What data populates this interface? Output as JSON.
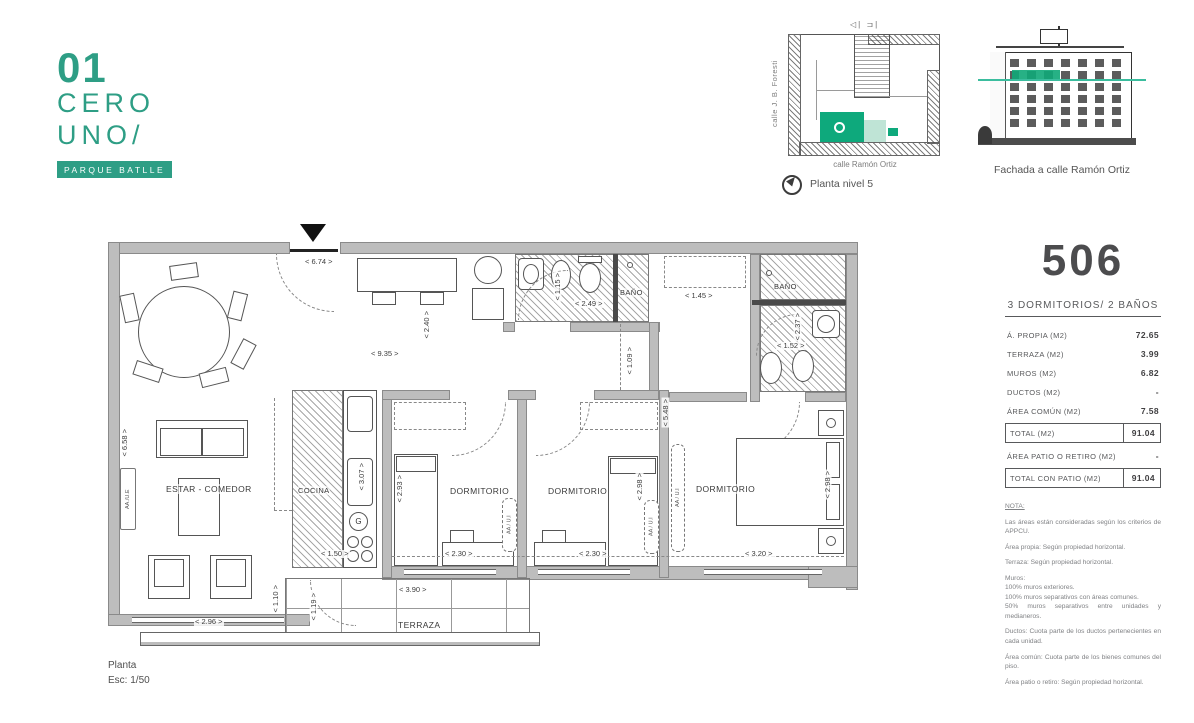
{
  "brand": {
    "number": "01",
    "word1": "CERO",
    "word2": "UNO/",
    "tagline": "PARQUE BATLLE"
  },
  "site_plan": {
    "section_markers": "◁|  ⊐|",
    "street_left": "calle J. B. Foresti",
    "street_bottom": "calle Ramón Ortiz",
    "caption": "Planta nivel 5"
  },
  "facade": {
    "caption": "Fachada a calle Ramón Ortiz"
  },
  "unit_panel": {
    "number": "506",
    "subtitle": "3 DORMITORIOS/ 2 BAÑOS",
    "rows": [
      {
        "label": "Á. PROPIA (M2)",
        "value": "72.65"
      },
      {
        "label": "TERRAZA (M2)",
        "value": "3.99"
      },
      {
        "label": "MUROS (M2)",
        "value": "6.82"
      },
      {
        "label": "DUCTOS  (M2)",
        "value": "-"
      },
      {
        "label": "ÁREA COMÚN (M2)",
        "value": "7.58"
      },
      {
        "label": "TOTAL (M2)",
        "value": "91.04"
      },
      {
        "label": "ÁREA PATIO O RETIRO (M2)",
        "value": "-"
      },
      {
        "label": "TOTAL CON PATIO (M2)",
        "value": "91.04"
      }
    ]
  },
  "notes": {
    "title": "NOTA:",
    "paragraphs": [
      "Las áreas están consideradas según los criterios de APPCU.",
      "Área propia: Según propiedad horizontal.",
      "Terraza: Según propiedad horizontal.",
      "Muros:\n100% muros exteriores.\n100% muros separativos con áreas comunes.\n50% muros separativos entre unidades y medianeros.",
      "Ductos: Cuota parte de los ductos pertenecientes en cada unidad.",
      "Área común: Cuota parte de los bienes comunes del piso.",
      "Área patio o retiro: Según propiedad horizontal."
    ]
  },
  "plan": {
    "labels": {
      "living": "ESTAR - COMEDOR",
      "kitchen": "COCINA",
      "bedroom": "DORMITORIO",
      "bath": "BAÑO",
      "terrace": "TERRAZA"
    },
    "dims": {
      "d674": "< 6.74 >",
      "d935": "< 9.35 >",
      "d240": "< 2.40 >",
      "d115": "< 1.15 >",
      "d249": "< 2.49 >",
      "d145": "< 1.45 >",
      "d237": "< 2.37 >",
      "d152": "< 1.52 >",
      "d109": "< 1.09 >",
      "d658": "< 6.58 >",
      "d307": "< 3.07 >",
      "d150": "< 1.50 >",
      "d293": "< 2.93 >",
      "d230": "< 2.30 >",
      "d298": "< 2.98 >",
      "d548": "< 5.48 >",
      "d320": "< 3.20 >",
      "d296": "< 2.96 >",
      "d110": "< 1.10 >",
      "d119": "< 1.19 >",
      "d390": "< 3.90 >"
    },
    "equipment": {
      "exterior_unit": "AA./U.E",
      "interior_unit": "AA / U.I",
      "gas": "G"
    },
    "title": "Planta",
    "scale": "Esc: 1/50"
  },
  "colors": {
    "teal": "#2e9e85",
    "green": "#0ea97c",
    "teal_line": "#3bbd9e",
    "wall_gray": "#bdbdbd"
  }
}
